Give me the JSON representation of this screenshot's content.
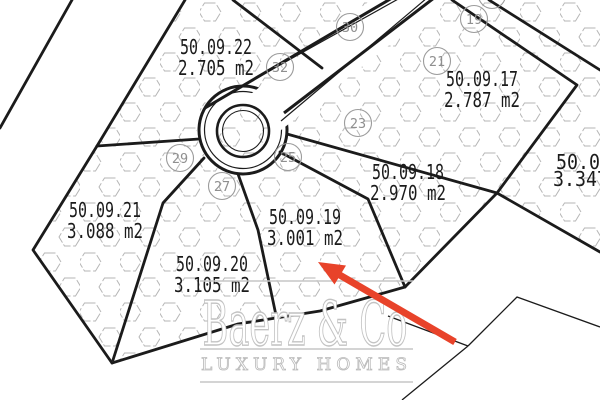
{
  "map": {
    "plots": [
      {
        "name": "50.09.22",
        "area": "2.705 m2",
        "x": 216,
        "y": 54,
        "clipped": false
      },
      {
        "name": "50.09.17",
        "area": "2.787 m2",
        "x": 482,
        "y": 86,
        "clipped": false
      },
      {
        "name": "50.09.18",
        "area": "2.970 m2",
        "x": 408,
        "y": 179,
        "clipped": false
      },
      {
        "name": "50.09.19",
        "area": "3.001 m2",
        "x": 305,
        "y": 224,
        "clipped": false
      },
      {
        "name": "50.09.20",
        "area": "3.105 m2",
        "x": 212,
        "y": 271,
        "clipped": false
      },
      {
        "name": "50.09.21",
        "area": "3.088 m2",
        "x": 105,
        "y": 217,
        "clipped": false
      },
      {
        "name": "50.09",
        "area": "3.347",
        "x": 556,
        "y": 169,
        "clipped": true
      }
    ],
    "markers": [
      {
        "n": "30",
        "x": 350,
        "y": 27
      },
      {
        "n": "32",
        "x": 280,
        "y": 67
      },
      {
        "n": "17",
        "x": 492,
        "y": -5
      },
      {
        "n": "19",
        "x": 474,
        "y": 19
      },
      {
        "n": "21",
        "x": 437,
        "y": 61
      },
      {
        "n": "23",
        "x": 358,
        "y": 123
      },
      {
        "n": "25",
        "x": 288,
        "y": 157
      },
      {
        "n": "27",
        "x": 222,
        "y": 186
      },
      {
        "n": "29",
        "x": 180,
        "y": 158
      }
    ]
  },
  "watermark": {
    "brand": "Baerz & Co",
    "tagline": "LUXURY HOMES"
  },
  "arrow": {
    "color": "#e8432a"
  },
  "colors": {
    "boundary_line": "#1b1b1b",
    "hatch": "#b6b6b6",
    "marker": "#9c9c9c",
    "watermark_gray": "#c6c6c6"
  }
}
